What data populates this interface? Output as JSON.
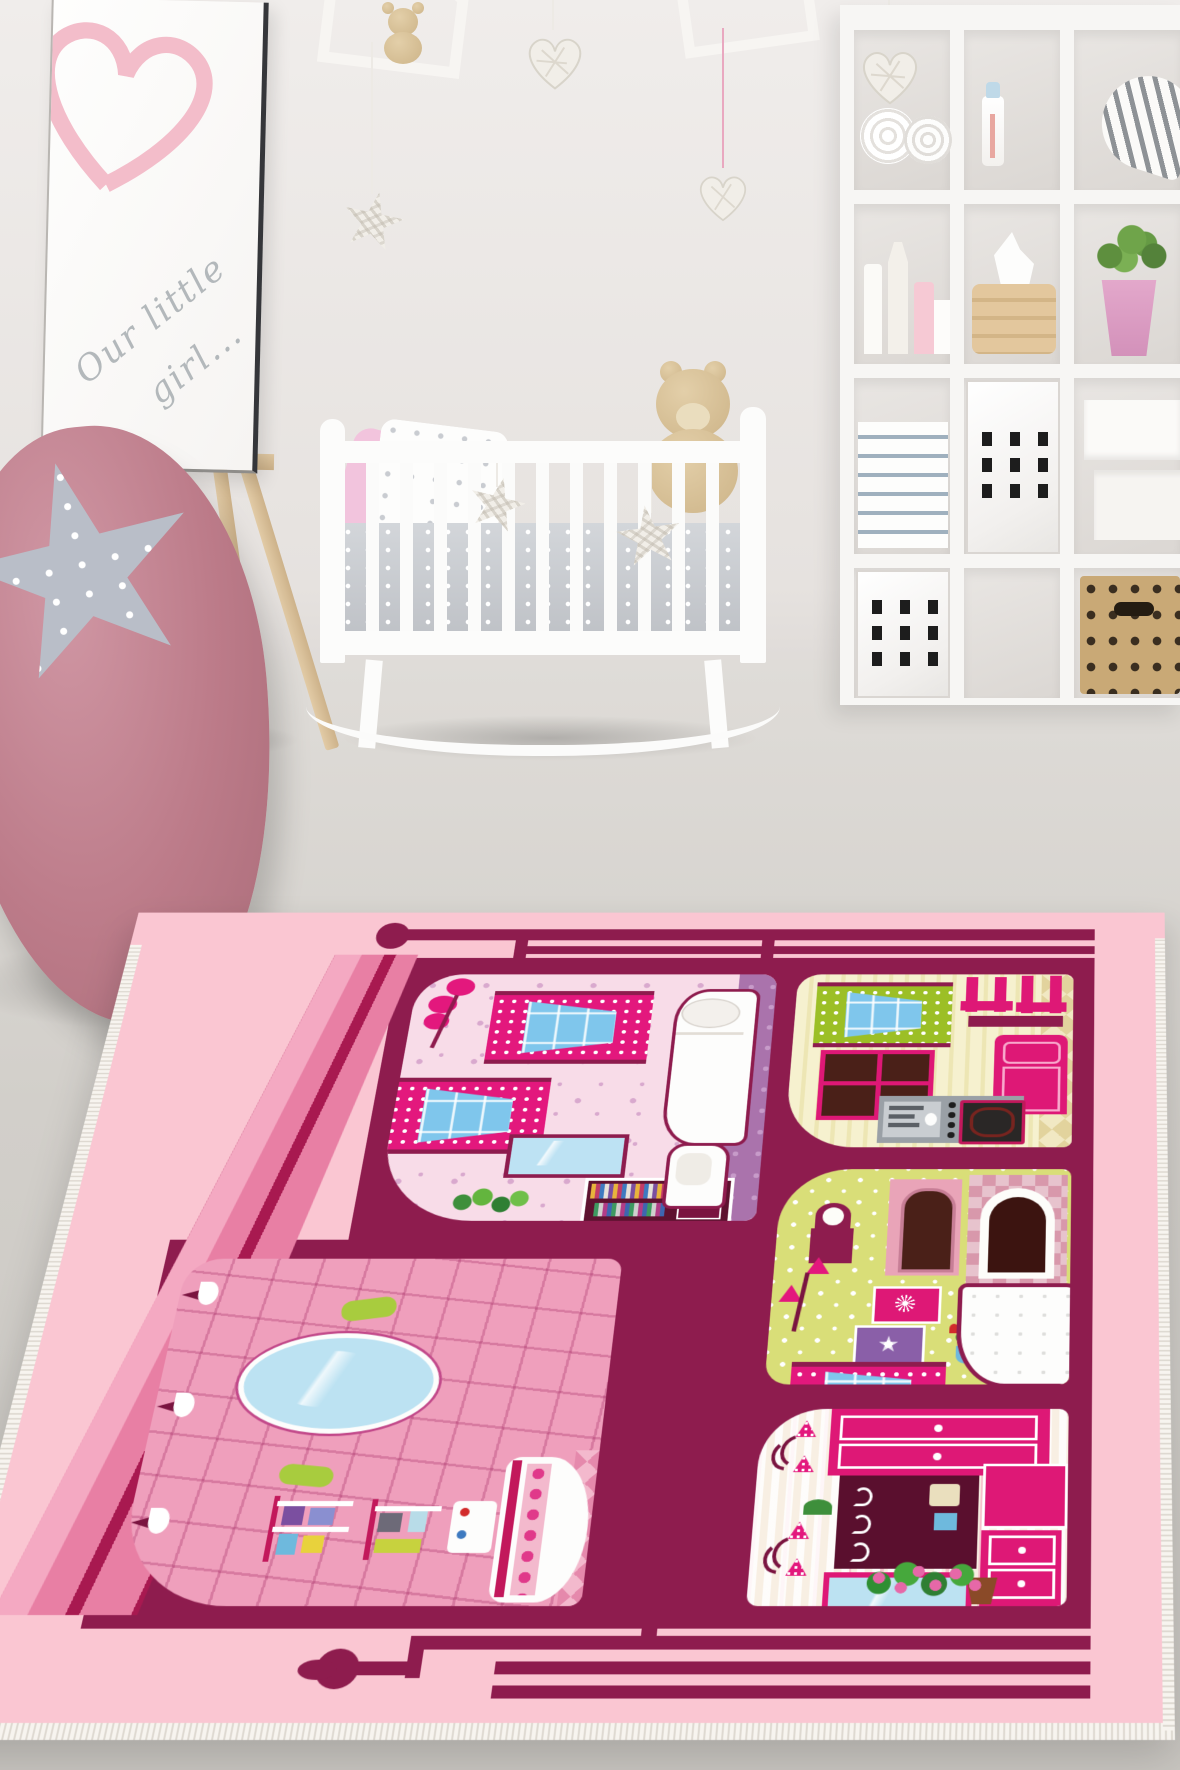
{
  "scene": {
    "description": "Nursery room product photo featuring a pink dollhouse-design children's play rug",
    "canvas": {
      "line1": "Our little",
      "line2": "girl..."
    },
    "objects": [
      "easel-canvas-with-heart",
      "house-shaped-wall-shelves",
      "wicker-hearts",
      "wicker-stars",
      "white-rocking-crib",
      "teddy-bear",
      "cube-storage-shelf",
      "rolled-towels",
      "baby-bottle",
      "striped-heart-cushion",
      "candles",
      "wooden-tissue-box",
      "potted-plant",
      "book-stack",
      "perforated-white-doors",
      "white-boxes",
      "wicker-basket",
      "pink-bean-bag",
      "grey-star-pillow",
      "dollhouse-play-rug"
    ],
    "rug_rooms": [
      "bedroom",
      "kitchen",
      "living-room",
      "bathroom",
      "dressing-room"
    ],
    "palette": {
      "rug_pink": "#FAC6D2",
      "rug_maroon": "#8E1C4E",
      "furniture_magenta": "#DE1876",
      "roof_pink": "#E87FA4",
      "bedroom_floor": "#F8DCE8",
      "kitchen_floor": "#F6F1CF",
      "living_floor": "#D9DE78",
      "bathroom_tile": "#EF9FBC",
      "glass_blue": "#7FC6EC",
      "purple_wall": "#AA73AC",
      "wall_grey": "#ECE9E7",
      "floor_grey": "#D2CFCA",
      "beanbag_rose": "#BC7B89",
      "wood": "#D9BE97"
    }
  }
}
